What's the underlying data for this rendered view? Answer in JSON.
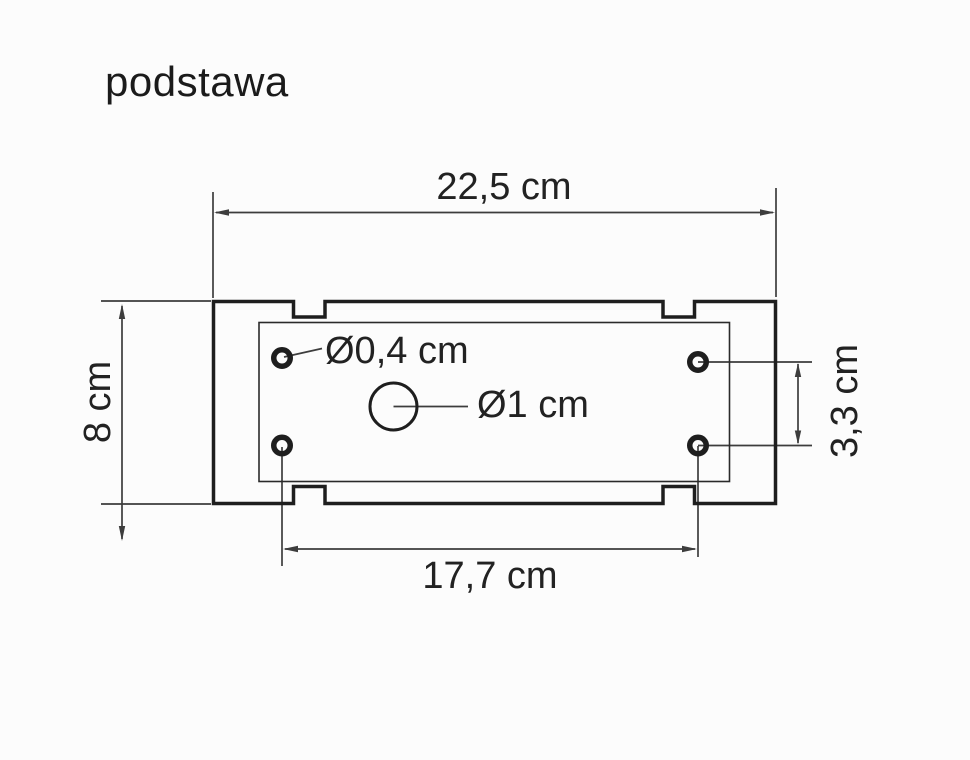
{
  "title": "podstawa",
  "drawing": {
    "labels": {
      "overall_width": "22,5 cm",
      "overall_height": "8 cm",
      "hole_pitch_horizontal": "17,7 cm",
      "hole_pitch_vertical": "3,3 cm",
      "small_hole_diameter": "Ø0,4 cm",
      "center_hole_diameter": "Ø1 cm"
    },
    "colors": {
      "ink": "#1e1e1e",
      "dimension_lines": "#3d3d3d",
      "background": "#fcfcfc"
    }
  }
}
